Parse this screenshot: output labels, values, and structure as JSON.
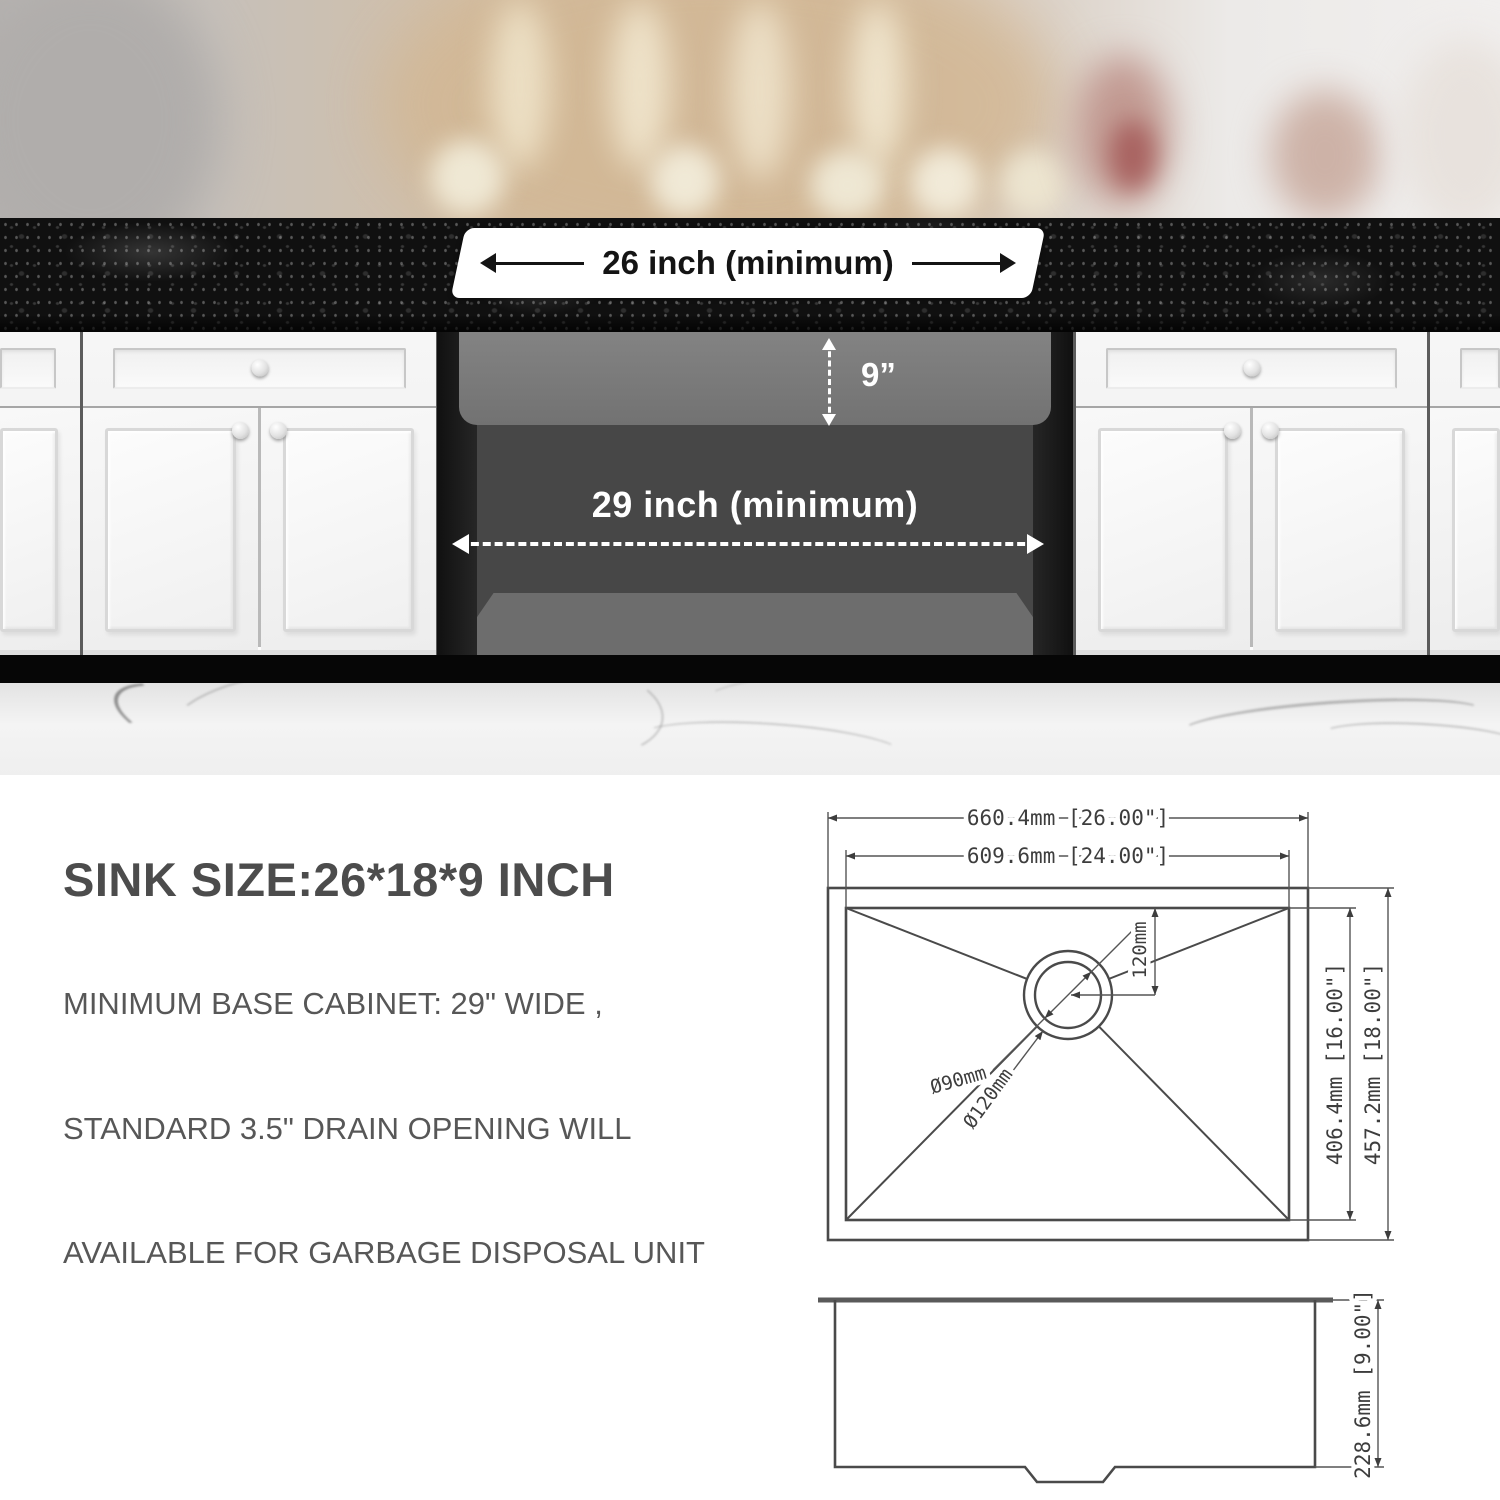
{
  "photo": {
    "countertop_dim_label": "26 inch (minimum)",
    "sink_depth_label": "9”",
    "cabinet_width_label": "29 inch (minimum)"
  },
  "info": {
    "title": "SINK SIZE:26*18*9 INCH",
    "lines": [
      "MINIMUM BASE CABINET: 29\" WIDE ,",
      "STANDARD 3.5\" DRAIN OPENING WILL",
      "AVAILABLE FOR GARBAGE DISPOSAL UNIT"
    ]
  },
  "drawing_top_view": {
    "overall_width": "660.4mm [26.00\"]",
    "bowl_width": "609.6mm [24.00\"]",
    "bowl_depth": "406.4mm [16.00\"]",
    "overall_depth": "457.2mm [18.00\"]",
    "drain_offset": "120mm",
    "drain_inner_diameter": "Ø90mm",
    "drain_outer_diameter": "Ø120mm"
  },
  "drawing_side_view": {
    "height": "228.6mm [9.00\"]"
  },
  "colors": {
    "countertop": "#101010",
    "annotation_white": "#ffffff",
    "annotation_black": "#141414",
    "info_text": "#4c4c4c",
    "drawing_stroke": "#4a4a4a"
  }
}
